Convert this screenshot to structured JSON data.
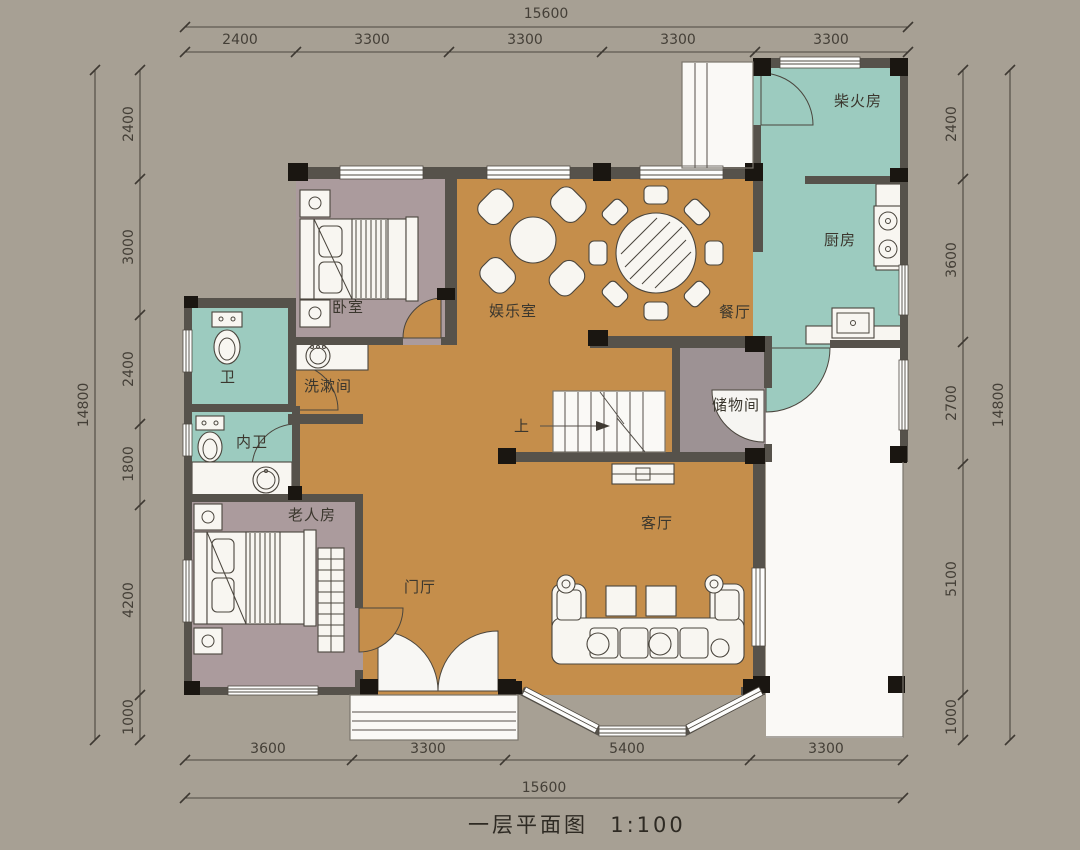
{
  "title": {
    "name": "一层平面图",
    "scale": "1:100"
  },
  "rooms": {
    "firewood": "柴火房",
    "kitchen": "厨房",
    "bedroom": "卧室",
    "entertainment": "娱乐室",
    "dining": "餐厅",
    "toilet": "卫",
    "washroom": "洗漱间",
    "ensuite": "内卫",
    "storage": "储物间",
    "elder_room": "老人房",
    "foyer": "门厅",
    "living": "客厅",
    "stairs_up": "上"
  },
  "dimensions": {
    "top": {
      "total": "15600",
      "segments": [
        "2400",
        "3300",
        "3300",
        "3300",
        "3300"
      ]
    },
    "bottom": {
      "total": "15600",
      "segments": [
        "3600",
        "3300",
        "5400",
        "3300"
      ]
    },
    "left": {
      "total": "14800",
      "segments": [
        "2400",
        "3000",
        "2400",
        "1800",
        "4200",
        "1000"
      ]
    },
    "right": {
      "total": "14800",
      "segments": [
        "2400",
        "3600",
        "2700",
        "5100",
        "1000"
      ]
    }
  },
  "colors": {
    "background": "#a7a094",
    "floor_main": "#c58e4b",
    "floor_wet": "#9ccbbf",
    "floor_bedroom": "#ab9b9d",
    "floor_storage": "#9d9294",
    "wall": "#56524b",
    "column": "#1a1611"
  }
}
